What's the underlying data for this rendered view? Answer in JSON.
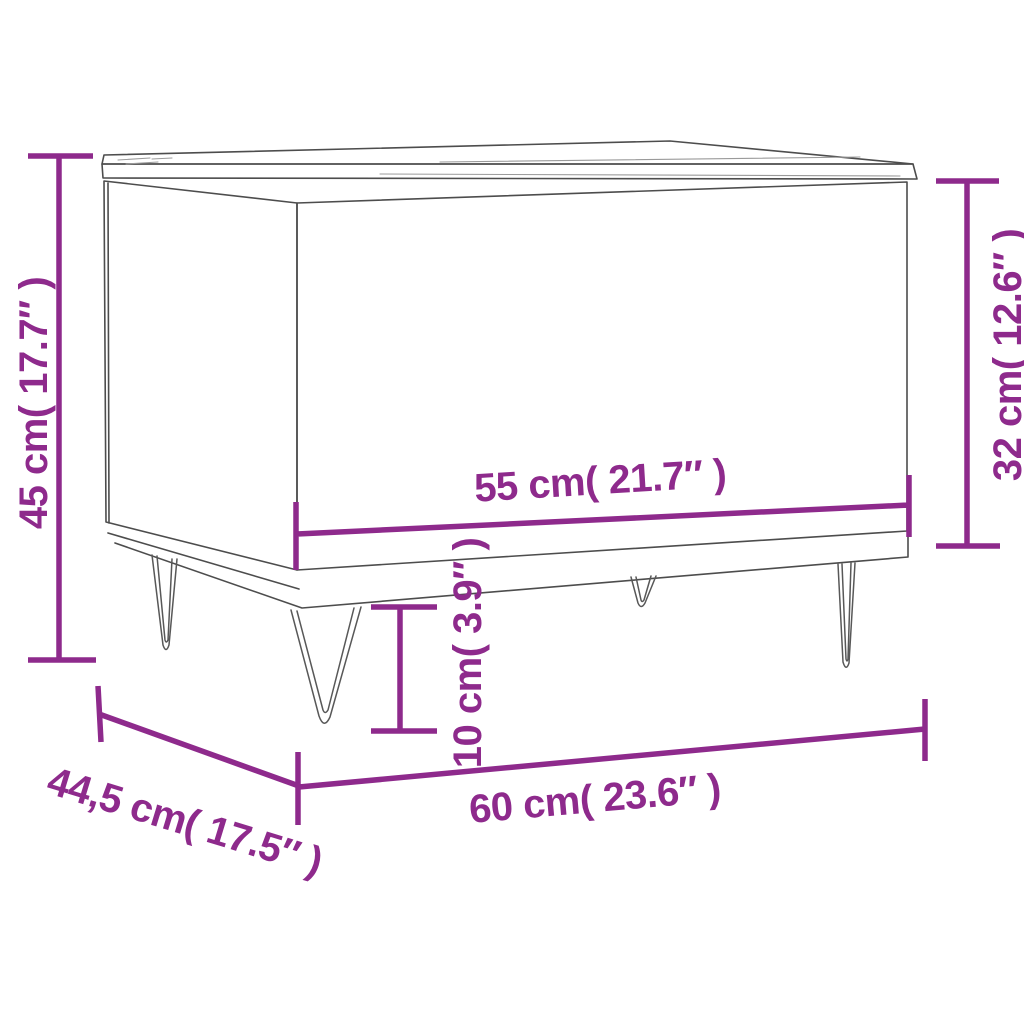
{
  "page": {
    "background": "#ffffff"
  },
  "diagram": {
    "kind": "furniture dimension diagram",
    "subject": "lift-top coffee table with hairpin legs",
    "accent_color": "#8e2a8c",
    "outline_color": "#4d4d4d",
    "labels": {
      "total_height": "45 cm( 17.7″ )",
      "body_height": "32 cm( 12.6″ )",
      "top_width": "55 cm( 21.7″ )",
      "leg_height": "10 cm( 3.9″ )",
      "total_width": "60 cm( 23.6″ )",
      "depth": "44,5 cm( 17.5″ )"
    }
  }
}
